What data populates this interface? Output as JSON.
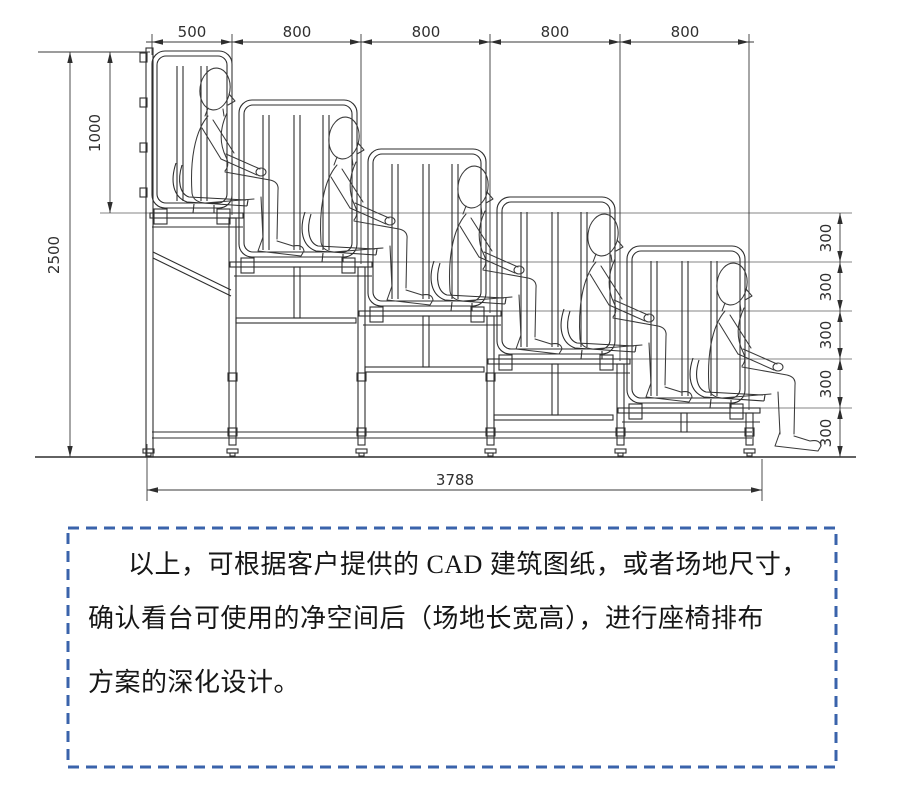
{
  "dims": {
    "top": [
      "500",
      "800",
      "800",
      "800",
      "800"
    ],
    "left": [
      "1000",
      "2500"
    ],
    "right": [
      "300",
      "300",
      "300",
      "300",
      "300"
    ],
    "bottom": "3788"
  },
  "note_box": {
    "border_color": "#3a63ab",
    "lines": [
      "以上，可根据客户提供的 CAD 建筑图纸，或者场地尺寸，",
      "确认看台可使用的净空间后（场地长宽高），进行座椅排布",
      "方案的深化设计。"
    ]
  }
}
